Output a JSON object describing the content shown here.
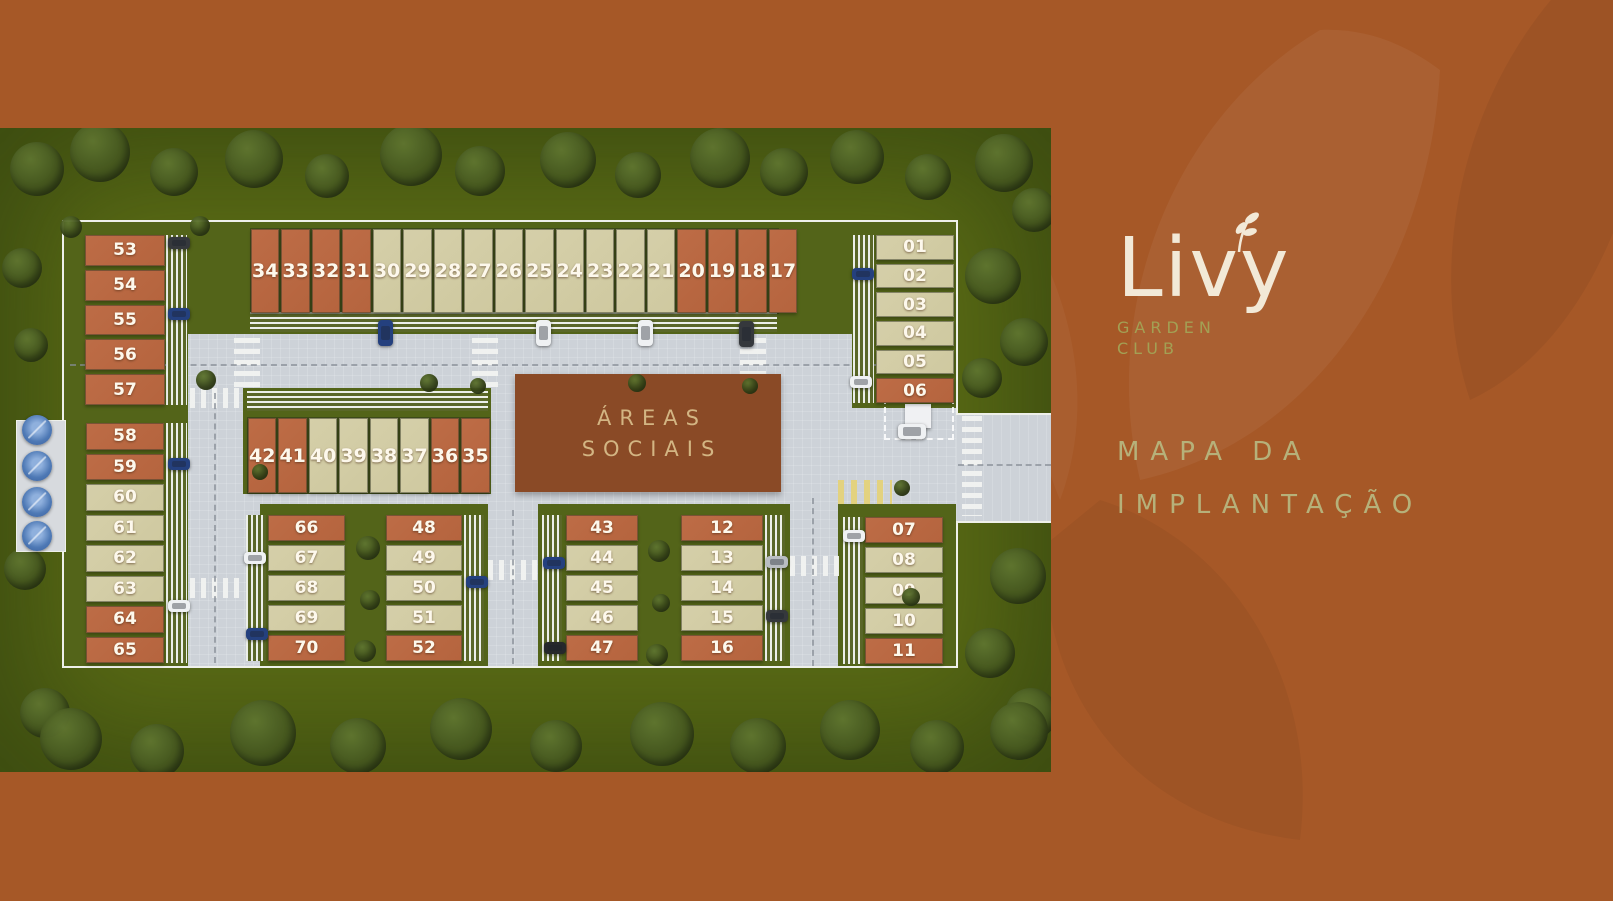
{
  "brand": {
    "name": "Livy",
    "subtitle_line1": "GARDEN",
    "subtitle_line2": "CLUB"
  },
  "title": {
    "line1": "MAPA DA",
    "line2": "IMPLANTAÇÃO"
  },
  "site": {
    "areas_sociais": {
      "line1": "ÁREAS",
      "line2": "SOCIAIS"
    },
    "colors": {
      "terracotta_lot": "#b5643e",
      "beige_lot": "#cfc9a0",
      "areas_sociais_bg": "#8a4a26",
      "panel_bg": "#a65827",
      "logo_cream": "#f2e9d7",
      "logo_olive": "#a3a054",
      "title_sage": "#b6b17a"
    },
    "groups": [
      {
        "id": "top_row",
        "layout": "row",
        "lots": [
          {
            "n": "34",
            "type": "terracotta"
          },
          {
            "n": "33",
            "type": "terracotta"
          },
          {
            "n": "32",
            "type": "terracotta"
          },
          {
            "n": "31",
            "type": "terracotta"
          },
          {
            "n": "30",
            "type": "beige"
          },
          {
            "n": "29",
            "type": "beige"
          },
          {
            "n": "28",
            "type": "beige"
          },
          {
            "n": "27",
            "type": "beige"
          },
          {
            "n": "26",
            "type": "beige"
          },
          {
            "n": "25",
            "type": "beige"
          },
          {
            "n": "24",
            "type": "beige"
          },
          {
            "n": "23",
            "type": "beige"
          },
          {
            "n": "22",
            "type": "beige"
          },
          {
            "n": "21",
            "type": "beige"
          },
          {
            "n": "20",
            "type": "terracotta"
          },
          {
            "n": "19",
            "type": "terracotta"
          },
          {
            "n": "18",
            "type": "terracotta"
          },
          {
            "n": "17",
            "type": "terracotta"
          }
        ]
      },
      {
        "id": "right_top",
        "layout": "column",
        "lots": [
          {
            "n": "01",
            "type": "beige"
          },
          {
            "n": "02",
            "type": "beige"
          },
          {
            "n": "03",
            "type": "beige"
          },
          {
            "n": "04",
            "type": "beige"
          },
          {
            "n": "05",
            "type": "beige"
          },
          {
            "n": "06",
            "type": "terracotta"
          }
        ]
      },
      {
        "id": "left_top",
        "layout": "column",
        "lots": [
          {
            "n": "53",
            "type": "terracotta"
          },
          {
            "n": "54",
            "type": "terracotta"
          },
          {
            "n": "55",
            "type": "terracotta"
          },
          {
            "n": "56",
            "type": "terracotta"
          },
          {
            "n": "57",
            "type": "terracotta"
          }
        ]
      },
      {
        "id": "left_bottom",
        "layout": "column",
        "lots": [
          {
            "n": "58",
            "type": "terracotta"
          },
          {
            "n": "59",
            "type": "terracotta"
          },
          {
            "n": "60",
            "type": "beige"
          },
          {
            "n": "61",
            "type": "beige"
          },
          {
            "n": "62",
            "type": "beige"
          },
          {
            "n": "63",
            "type": "beige"
          },
          {
            "n": "64",
            "type": "terracotta"
          },
          {
            "n": "65",
            "type": "terracotta"
          }
        ]
      },
      {
        "id": "mid_row",
        "layout": "row",
        "lots": [
          {
            "n": "42",
            "type": "terracotta"
          },
          {
            "n": "41",
            "type": "terracotta"
          },
          {
            "n": "40",
            "type": "beige"
          },
          {
            "n": "39",
            "type": "beige"
          },
          {
            "n": "38",
            "type": "beige"
          },
          {
            "n": "37",
            "type": "beige"
          },
          {
            "n": "36",
            "type": "terracotta"
          },
          {
            "n": "35",
            "type": "terracotta"
          }
        ]
      },
      {
        "id": "block_66",
        "layout": "column",
        "lots": [
          {
            "n": "66",
            "type": "terracotta"
          },
          {
            "n": "67",
            "type": "beige"
          },
          {
            "n": "68",
            "type": "beige"
          },
          {
            "n": "69",
            "type": "beige"
          },
          {
            "n": "70",
            "type": "terracotta"
          }
        ]
      },
      {
        "id": "block_48",
        "layout": "column",
        "lots": [
          {
            "n": "48",
            "type": "terracotta"
          },
          {
            "n": "49",
            "type": "beige"
          },
          {
            "n": "50",
            "type": "beige"
          },
          {
            "n": "51",
            "type": "beige"
          },
          {
            "n": "52",
            "type": "terracotta"
          }
        ]
      },
      {
        "id": "block_43",
        "layout": "column",
        "lots": [
          {
            "n": "43",
            "type": "terracotta"
          },
          {
            "n": "44",
            "type": "beige"
          },
          {
            "n": "45",
            "type": "beige"
          },
          {
            "n": "46",
            "type": "beige"
          },
          {
            "n": "47",
            "type": "terracotta"
          }
        ]
      },
      {
        "id": "block_12",
        "layout": "column",
        "lots": [
          {
            "n": "12",
            "type": "terracotta"
          },
          {
            "n": "13",
            "type": "beige"
          },
          {
            "n": "14",
            "type": "beige"
          },
          {
            "n": "15",
            "type": "beige"
          },
          {
            "n": "16",
            "type": "terracotta"
          }
        ]
      },
      {
        "id": "block_07",
        "layout": "column",
        "lots": [
          {
            "n": "07",
            "type": "terracotta"
          },
          {
            "n": "08",
            "type": "beige"
          },
          {
            "n": "09",
            "type": "beige"
          },
          {
            "n": "10",
            "type": "beige"
          },
          {
            "n": "11",
            "type": "terracotta"
          }
        ]
      }
    ]
  }
}
